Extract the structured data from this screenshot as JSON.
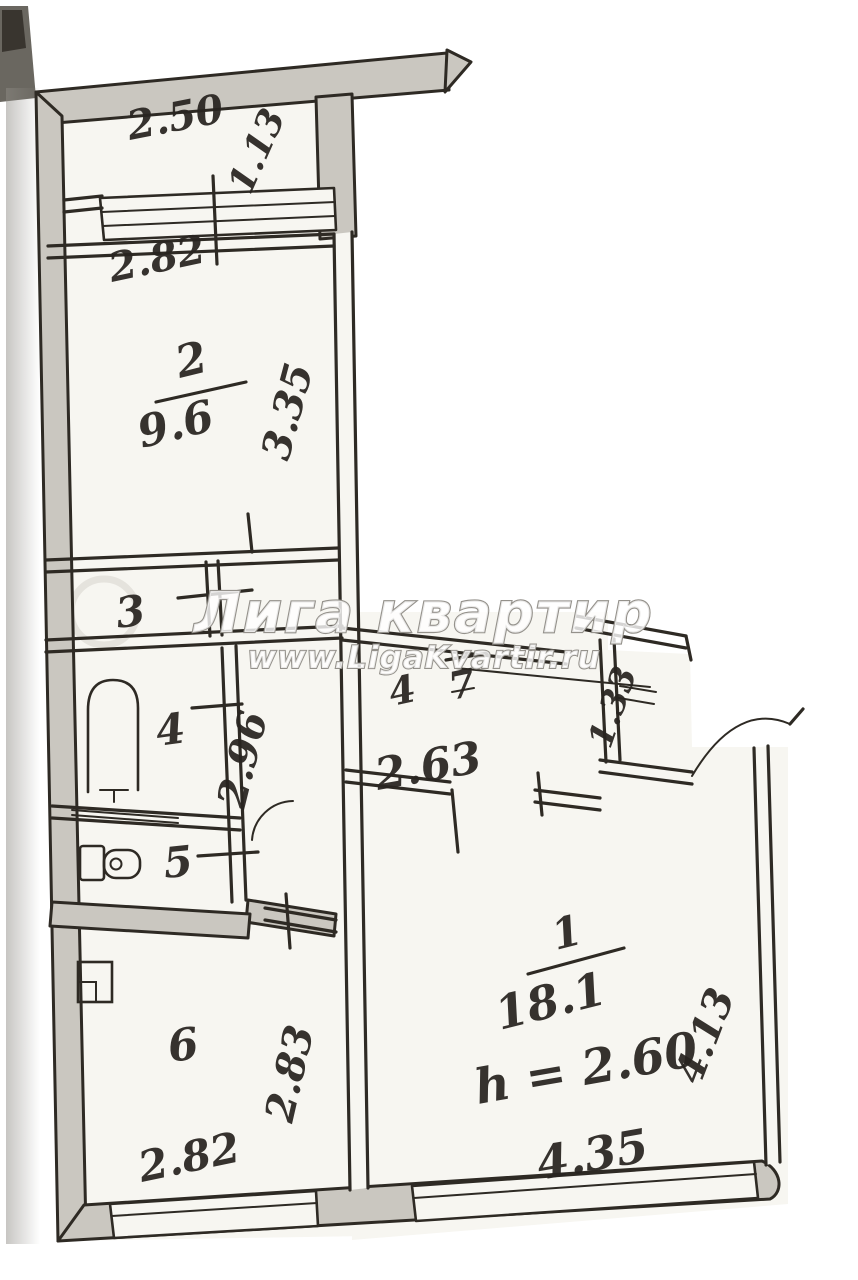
{
  "watermark": {
    "brand": "Лига квартир",
    "site": "www.LigaKvartir.ru"
  },
  "plan": {
    "balcony": {
      "width": "2.50",
      "depth": "1.13"
    },
    "room2": {
      "number": "2",
      "area": "9.6",
      "width_top": "2.82",
      "depth_right": "3.35"
    },
    "room3": {
      "number": "3"
    },
    "room4": {
      "number": "4"
    },
    "corridor": {
      "length": "2.96"
    },
    "room5": {
      "number": "5"
    },
    "room6": {
      "number": "6",
      "width_bottom": "2.82",
      "depth_right": "2.83"
    },
    "hallway": {
      "label_left": "4",
      "label_right": "7",
      "width": "2.63",
      "entry_width": "1.33"
    },
    "room1": {
      "number": "1",
      "area": "18.1",
      "ceiling_height": "h = 2.60",
      "width_bottom": "4.35",
      "depth_right": "4.13"
    }
  }
}
